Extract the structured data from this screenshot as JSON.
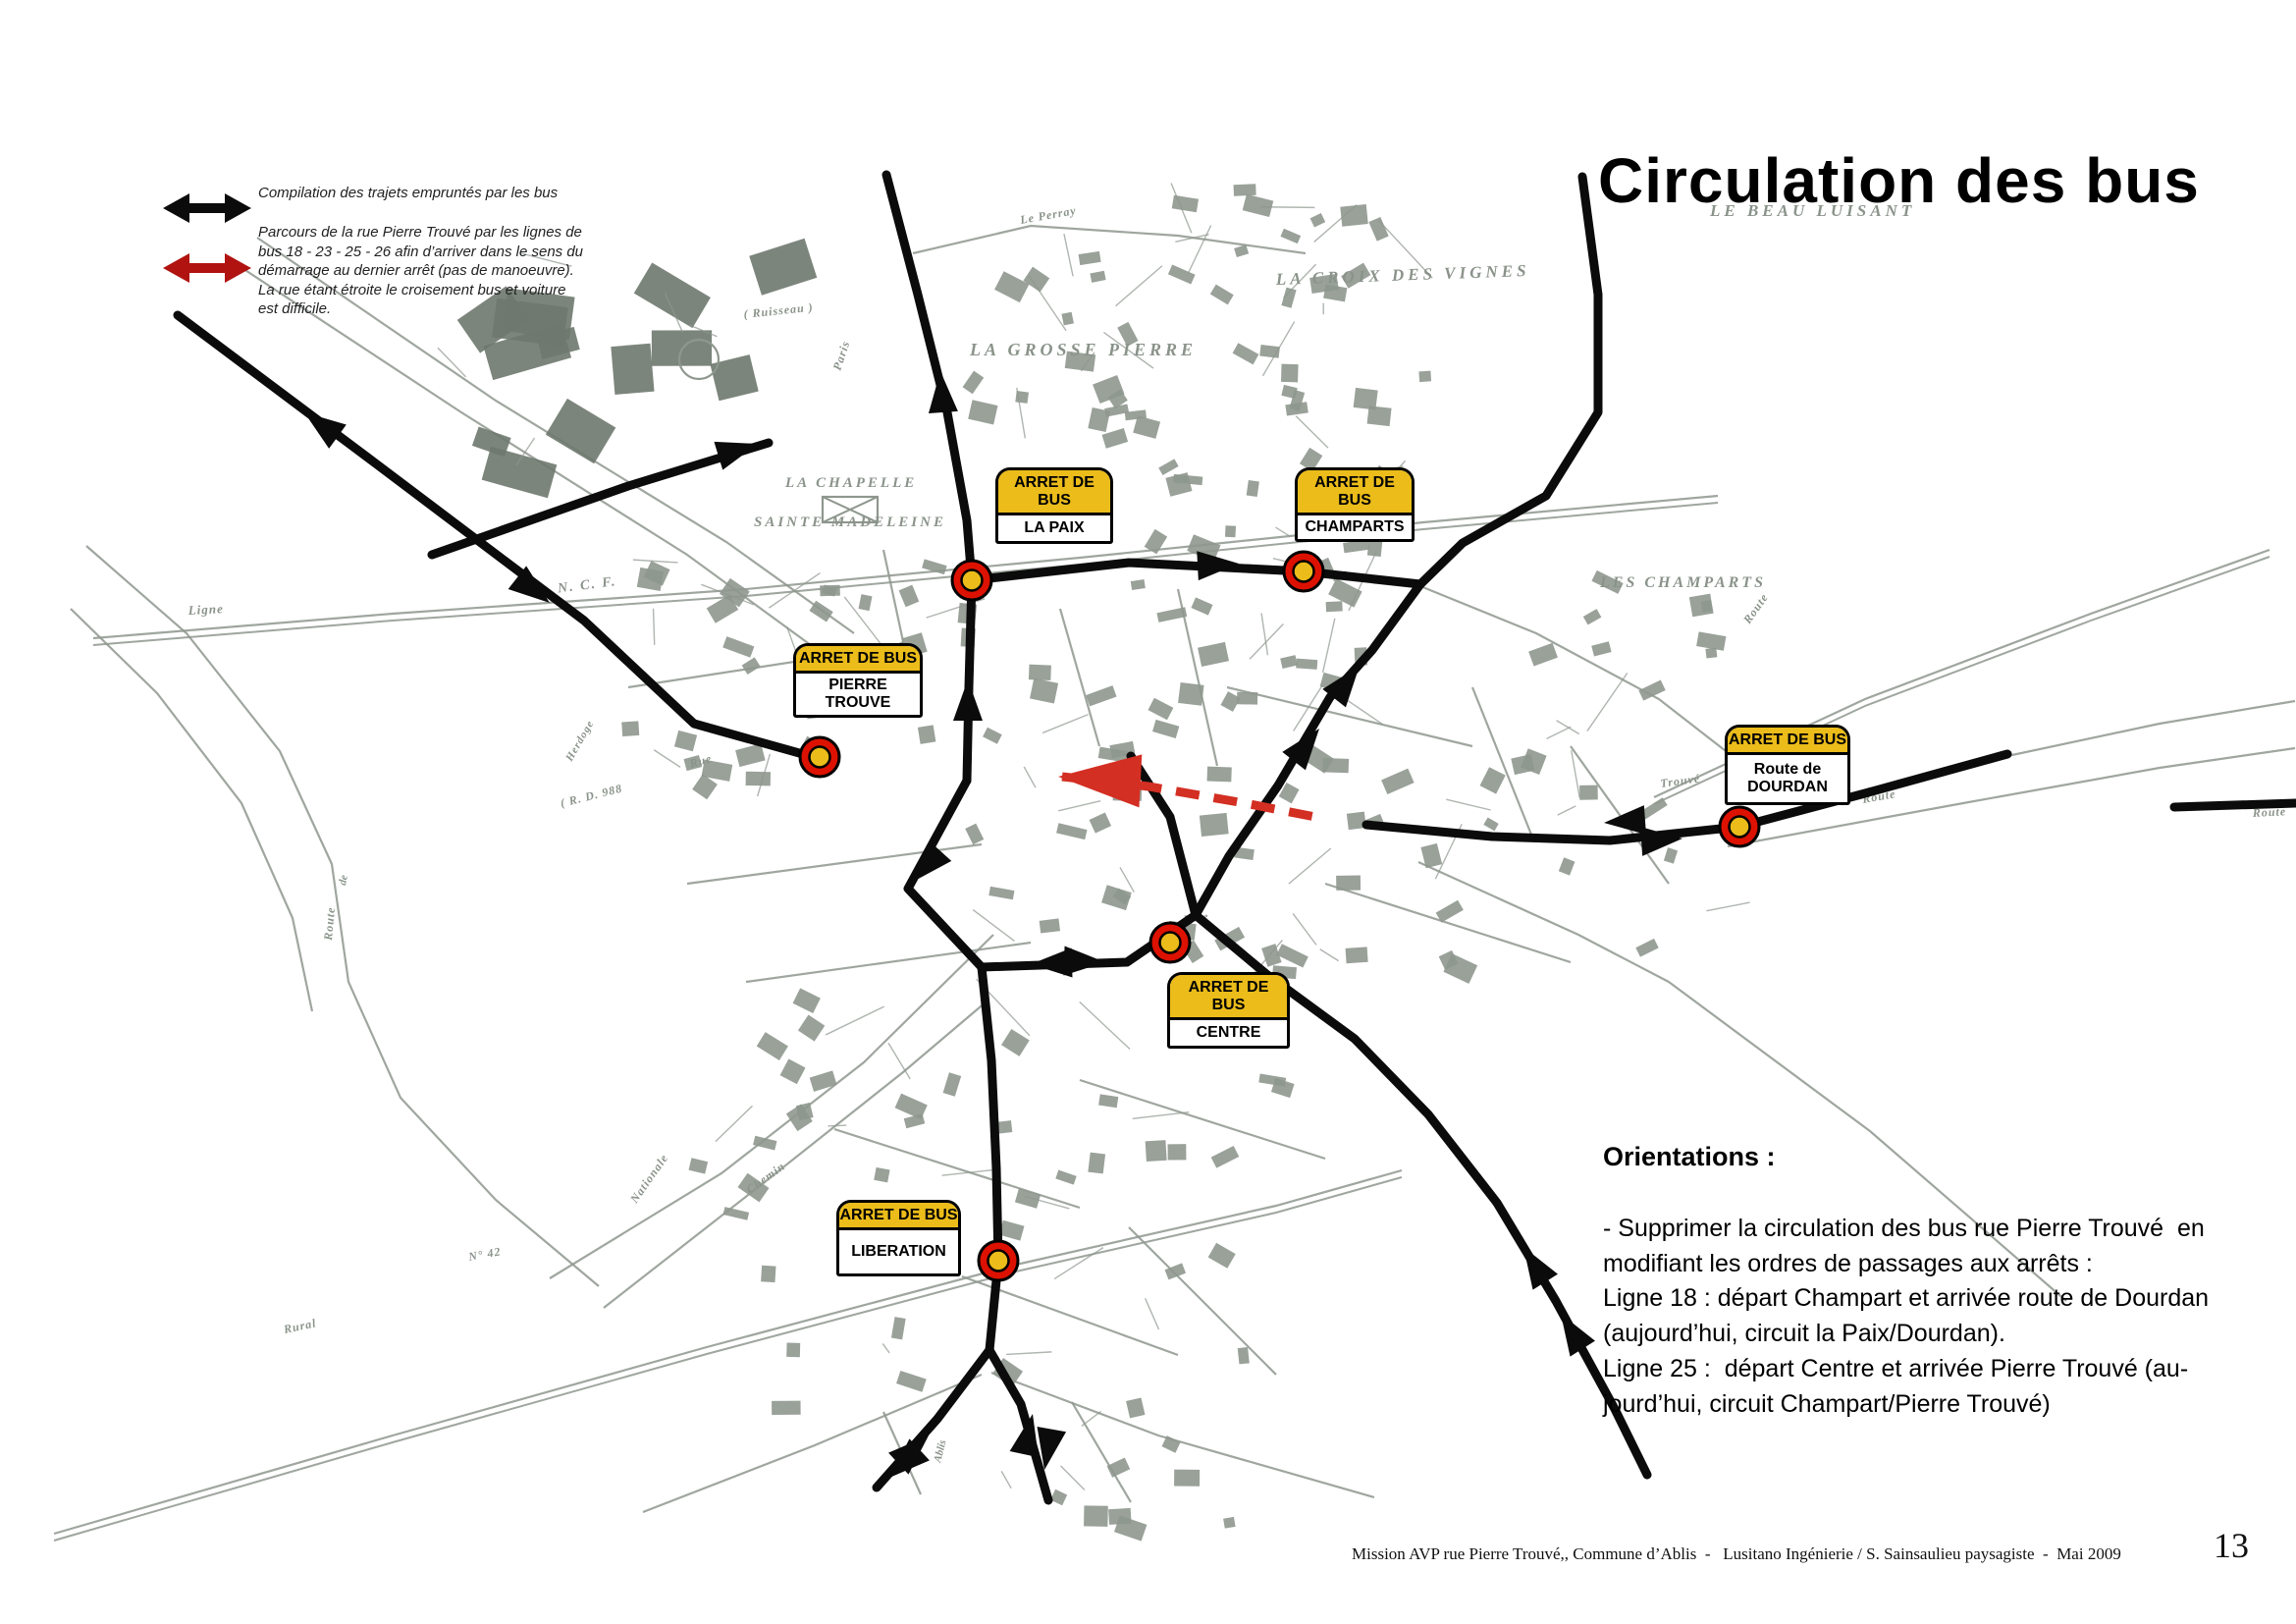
{
  "page": {
    "title": "Circulation des bus",
    "footer": {
      "text": "Mission AVP rue Pierre Trouvé,, Commune d’Ablis  -   Lusitano Ingénierie / S. Sainsaulieu paysagiste  -  Mai 2009",
      "page_number": "13"
    }
  },
  "colors": {
    "map_gray": "#8E978E",
    "label_gray": "#8A938A",
    "route_black": "#0B0B0B",
    "route_red": "#D32F23",
    "legend_red": "#B01310",
    "stop_yellow": "#EBBC1A",
    "stop_ring_red": "#DD1100",
    "background": "#FFFFFF"
  },
  "legend": {
    "items": [
      {
        "symbol": "black-double-arrow",
        "text": "Compilation des trajets empruntés par les bus"
      },
      {
        "symbol": "red-double-arrow",
        "text": "Parcours de la rue Pierre Trouvé par les lignes de bus 18 - 23 - 25 - 26 afin d’arriver dans le sens du démarrage au dernier arrêt (pas de manoeuvre). La rue étant étroite le croisement bus et voiture est difficile."
      }
    ]
  },
  "orientations": {
    "heading": "Orientations :",
    "lines": [
      "- Supprimer la circulation des bus rue Pierre Trouvé  en",
      "modifiant les ordres de passages aux arrêts :",
      "Ligne 18 : départ Champart et arrivée route de Dourdan",
      "(aujourd’hui, circuit la Paix/Dourdan).",
      "Ligne 25 :  départ Centre et arrivée Pierre Trouvé (au-",
      "jourd’hui, circuit Champart/Pierre Trouvé)"
    ]
  },
  "bus_stops": [
    {
      "header": "ARRET DE BUS",
      "name_lines": [
        "LA PAIX"
      ],
      "box": [
        1014,
        476,
        120,
        78
      ],
      "marker": [
        990,
        591
      ]
    },
    {
      "header": "ARRET DE BUS",
      "name_lines": [
        "CHAMPARTS"
      ],
      "box": [
        1319,
        476,
        122,
        76
      ],
      "marker": [
        1328,
        582
      ]
    },
    {
      "header": "ARRET DE BUS",
      "name_lines": [
        "PIERRE TROUVE"
      ],
      "box": [
        808,
        655,
        132,
        76
      ],
      "marker": [
        835,
        771
      ]
    },
    {
      "header": "ARRET DE BUS",
      "name_lines": [
        "Route de",
        "DOURDAN"
      ],
      "box": [
        1757,
        738,
        128,
        82
      ],
      "marker": [
        1772,
        842
      ]
    },
    {
      "header": "ARRET DE BUS",
      "name_lines": [
        "CENTRE"
      ],
      "box": [
        1189,
        990,
        125,
        78
      ],
      "marker": [
        1192,
        960
      ]
    },
    {
      "header": "ARRET DE BUS",
      "name_lines": [
        "LIBERATION"
      ],
      "box": [
        852,
        1222,
        127,
        78
      ],
      "marker": [
        1017,
        1284
      ]
    }
  ],
  "map": {
    "labels": [
      [
        "LE BEAU LUISANT",
        1742,
        220,
        0,
        17,
        4
      ],
      [
        "LA CROIX DES VIGNES",
        1300,
        290,
        -2,
        17,
        4
      ],
      [
        "LA GROSSE PIERRE",
        988,
        362,
        0,
        18,
        4
      ],
      [
        "LA CHAPELLE",
        800,
        496,
        0,
        15,
        3
      ],
      [
        "SAINTE MADELEINE",
        768,
        536,
        0,
        15,
        3
      ],
      [
        "LES CHAMPARTS",
        1630,
        598,
        0,
        16,
        3
      ],
      [
        "S. N. C. F.",
        548,
        606,
        -7,
        14,
        2
      ],
      [
        "Ligne",
        192,
        626,
        -3,
        13,
        1
      ],
      [
        "Le Perray",
        1040,
        228,
        -10,
        12,
        1
      ],
      [
        "( Ruisseau )",
        758,
        324,
        -6,
        12,
        1
      ],
      [
        "Paris",
        856,
        378,
        -72,
        12,
        1
      ],
      [
        "Route",
        1782,
        636,
        -55,
        12,
        1
      ],
      [
        "Route",
        1898,
        818,
        -10,
        12,
        1
      ],
      [
        "Route",
        2295,
        832,
        -3,
        12,
        1
      ],
      [
        "Trouvé",
        1692,
        802,
        -8,
        12,
        1
      ],
      [
        "Rue",
        704,
        782,
        -16,
        12,
        1
      ],
      [
        "( R. D. 988",
        572,
        822,
        -14,
        12,
        1
      ],
      [
        "Herdoge",
        582,
        776,
        -60,
        11,
        1
      ],
      [
        "Place",
        1206,
        940,
        -8,
        11,
        0
      ],
      [
        "Paix",
        1358,
        592,
        -12,
        11,
        0
      ],
      [
        "Nationale",
        648,
        1226,
        -55,
        12,
        1
      ],
      [
        "N° 42",
        478,
        1284,
        -10,
        12,
        1
      ],
      [
        "Rural",
        290,
        1358,
        -12,
        12,
        1
      ],
      [
        "Chemin",
        764,
        1216,
        -36,
        12,
        1
      ],
      [
        "Ablis",
        958,
        1490,
        -76,
        11,
        0
      ],
      [
        "Route",
        338,
        958,
        -85,
        12,
        1
      ],
      [
        "de",
        352,
        902,
        -80,
        11,
        0
      ]
    ],
    "roads": [
      {
        "pts": [
          [
            95,
            650
          ],
          [
            400,
            625
          ],
          [
            760,
            600
          ],
          [
            1100,
            568
          ],
          [
            1450,
            532
          ],
          [
            1750,
            505
          ]
        ],
        "double": true
      },
      {
        "pts": [
          [
            230,
            262
          ],
          [
            470,
            420
          ],
          [
            700,
            565
          ],
          [
            830,
            660
          ]
        ]
      },
      {
        "pts": [
          [
            262,
            242
          ],
          [
            505,
            408
          ],
          [
            740,
            552
          ],
          [
            870,
            645
          ]
        ]
      },
      {
        "pts": [
          [
            930,
            258
          ],
          [
            1050,
            230
          ],
          [
            1200,
            240
          ],
          [
            1330,
            258
          ]
        ]
      },
      {
        "pts": [
          [
            1685,
            812
          ],
          [
            1900,
            712
          ],
          [
            2130,
            625
          ],
          [
            2312,
            560
          ]
        ],
        "double": true
      },
      {
        "pts": [
          [
            2045,
            770
          ],
          [
            2200,
            737
          ],
          [
            2338,
            714
          ]
        ]
      },
      {
        "pts": [
          [
            1760,
            862
          ],
          [
            2000,
            818
          ],
          [
            2200,
            782
          ],
          [
            2338,
            762
          ]
        ]
      },
      {
        "pts": [
          [
            88,
            556
          ],
          [
            190,
            645
          ],
          [
            285,
            765
          ],
          [
            338,
            880
          ],
          [
            355,
            1000
          ],
          [
            408,
            1118
          ],
          [
            505,
            1222
          ],
          [
            610,
            1310
          ]
        ]
      },
      {
        "pts": [
          [
            72,
            620
          ],
          [
            160,
            706
          ],
          [
            246,
            818
          ],
          [
            298,
            935
          ],
          [
            318,
            1030
          ]
        ]
      },
      {
        "pts": [
          [
            55,
            1562
          ],
          [
            400,
            1462
          ],
          [
            720,
            1372
          ],
          [
            1035,
            1288
          ],
          [
            1300,
            1228
          ],
          [
            1428,
            1192
          ]
        ],
        "double": true
      },
      {
        "pts": [
          [
            1012,
            952
          ],
          [
            880,
            1082
          ],
          [
            735,
            1195
          ],
          [
            560,
            1302
          ]
        ]
      },
      {
        "pts": [
          [
            615,
            1332
          ],
          [
            775,
            1207
          ],
          [
            920,
            1092
          ],
          [
            1005,
            1020
          ]
        ]
      },
      {
        "pts": [
          [
            900,
            1438
          ],
          [
            938,
            1522
          ]
        ]
      },
      {
        "pts": [
          [
            1092,
            1428
          ],
          [
            1152,
            1530
          ]
        ]
      },
      {
        "pts": [
          [
            1010,
            1398
          ],
          [
            1180,
            1462
          ],
          [
            1400,
            1525
          ]
        ]
      },
      {
        "pts": [
          [
            1000,
            1400
          ],
          [
            830,
            1472
          ],
          [
            655,
            1540
          ]
        ]
      },
      {
        "pts": [
          [
            1700,
            1000
          ],
          [
            1905,
            1152
          ],
          [
            2105,
            1325
          ]
        ]
      },
      {
        "pts": [
          [
            1445,
            878
          ],
          [
            1608,
            952
          ],
          [
            1700,
            1000
          ]
        ]
      },
      {
        "pts": [
          [
            1447,
            597
          ],
          [
            1565,
            645
          ],
          [
            1690,
            712
          ],
          [
            1762,
            768
          ]
        ]
      },
      {
        "pts": [
          [
            640,
            700
          ],
          [
            900,
            660
          ]
        ]
      },
      {
        "pts": [
          [
            700,
            900
          ],
          [
            1000,
            860
          ]
        ]
      },
      {
        "pts": [
          [
            1080,
            620
          ],
          [
            1120,
            760
          ]
        ]
      },
      {
        "pts": [
          [
            1200,
            600
          ],
          [
            1240,
            780
          ]
        ]
      },
      {
        "pts": [
          [
            760,
            1000
          ],
          [
            1050,
            960
          ]
        ]
      },
      {
        "pts": [
          [
            1100,
            1100
          ],
          [
            1350,
            1180
          ]
        ]
      },
      {
        "pts": [
          [
            1250,
            700
          ],
          [
            1500,
            760
          ]
        ]
      },
      {
        "pts": [
          [
            1350,
            900
          ],
          [
            1600,
            980
          ]
        ]
      },
      {
        "pts": [
          [
            850,
            1150
          ],
          [
            1100,
            1230
          ]
        ]
      },
      {
        "pts": [
          [
            900,
            560
          ],
          [
            930,
            700
          ]
        ]
      },
      {
        "pts": [
          [
            1500,
            700
          ],
          [
            1560,
            850
          ]
        ]
      },
      {
        "pts": [
          [
            1600,
            760
          ],
          [
            1700,
            900
          ]
        ]
      },
      {
        "pts": [
          [
            1150,
            1250
          ],
          [
            1300,
            1400
          ]
        ]
      },
      {
        "pts": [
          [
            980,
            1300
          ],
          [
            1200,
            1380
          ]
        ]
      }
    ]
  },
  "routes": {
    "black": [
      {
        "pts": [
          [
            181,
            321
          ],
          [
            376,
            467
          ],
          [
            595,
            632
          ],
          [
            707,
            737
          ],
          [
            843,
            775
          ]
        ]
      },
      {
        "pts": [
          [
            440,
            565
          ],
          [
            640,
            495
          ],
          [
            783,
            451
          ]
        ]
      },
      {
        "pts": [
          [
            903,
            178
          ],
          [
            935,
            300
          ],
          [
            965,
            420
          ],
          [
            985,
            530
          ],
          [
            990,
            591
          ],
          [
            987,
            700
          ],
          [
            985,
            795
          ]
        ]
      },
      {
        "pts": [
          [
            990,
            591
          ],
          [
            1150,
            573
          ],
          [
            1328,
            582
          ],
          [
            1447,
            595
          ]
        ]
      },
      {
        "pts": [
          [
            1612,
            180
          ],
          [
            1628,
            300
          ],
          [
            1628,
            420
          ],
          [
            1575,
            505
          ],
          [
            1490,
            553
          ],
          [
            1447,
            595
          ]
        ]
      },
      {
        "pts": [
          [
            1447,
            595
          ],
          [
            1398,
            662
          ],
          [
            1355,
            710
          ],
          [
            1302,
            800
          ],
          [
            1252,
            872
          ],
          [
            1218,
            932
          ]
        ]
      },
      {
        "pts": [
          [
            1152,
            770
          ],
          [
            1192,
            832
          ],
          [
            1218,
            932
          ]
        ]
      },
      {
        "pts": [
          [
            1218,
            932
          ],
          [
            1290,
            992
          ],
          [
            1380,
            1058
          ],
          [
            1455,
            1135
          ],
          [
            1525,
            1225
          ],
          [
            1585,
            1325
          ],
          [
            1645,
            1435
          ],
          [
            1678,
            1502
          ]
        ]
      },
      {
        "pts": [
          [
            1000,
            985
          ],
          [
            1148,
            980
          ],
          [
            1218,
            932
          ]
        ]
      },
      {
        "pts": [
          [
            985,
            795
          ],
          [
            925,
            905
          ],
          [
            1000,
            985
          ]
        ]
      },
      {
        "pts": [
          [
            1000,
            985
          ],
          [
            1010,
            1080
          ],
          [
            1015,
            1190
          ],
          [
            1017,
            1284
          ],
          [
            1008,
            1375
          ]
        ]
      },
      {
        "pts": [
          [
            1008,
            1375
          ],
          [
            955,
            1445
          ],
          [
            893,
            1515
          ]
        ]
      },
      {
        "pts": [
          [
            1008,
            1375
          ],
          [
            1040,
            1430
          ],
          [
            1068,
            1528
          ]
        ]
      },
      {
        "pts": [
          [
            1392,
            840
          ],
          [
            1520,
            852
          ],
          [
            1640,
            856
          ],
          [
            1772,
            842
          ],
          [
            1900,
            808
          ],
          [
            2045,
            768
          ]
        ]
      },
      {
        "pts": [
          [
            2215,
            822
          ],
          [
            2339,
            818
          ]
        ]
      }
    ],
    "arrowheads": [
      [
        560,
        614,
        38
      ],
      [
        310,
        420,
        -144
      ],
      [
        772,
        452,
        -17
      ],
      [
        958,
        378,
        -94
      ],
      [
        986,
        692,
        -90
      ],
      [
        1262,
        574,
        -3
      ],
      [
        1385,
        678,
        -52
      ],
      [
        1344,
        742,
        -52
      ],
      [
        1552,
        1270,
        -122
      ],
      [
        1590,
        1338,
        -122
      ],
      [
        1050,
        982,
        178
      ],
      [
        1126,
        980,
        2
      ],
      [
        930,
        898,
        132
      ],
      [
        906,
        1505,
        137
      ],
      [
        946,
        1462,
        -43
      ],
      [
        1052,
        1440,
        -78
      ],
      [
        1064,
        1497,
        100
      ],
      [
        1634,
        838,
        176
      ],
      [
        1714,
        854,
        -4
      ]
    ],
    "red_dashed": {
      "pts": [
        [
          1082,
          791
        ],
        [
          1170,
          801
        ],
        [
          1268,
          818
        ],
        [
          1345,
          833
        ]
      ],
      "arrow": [
        1078,
        791,
        183
      ]
    }
  }
}
